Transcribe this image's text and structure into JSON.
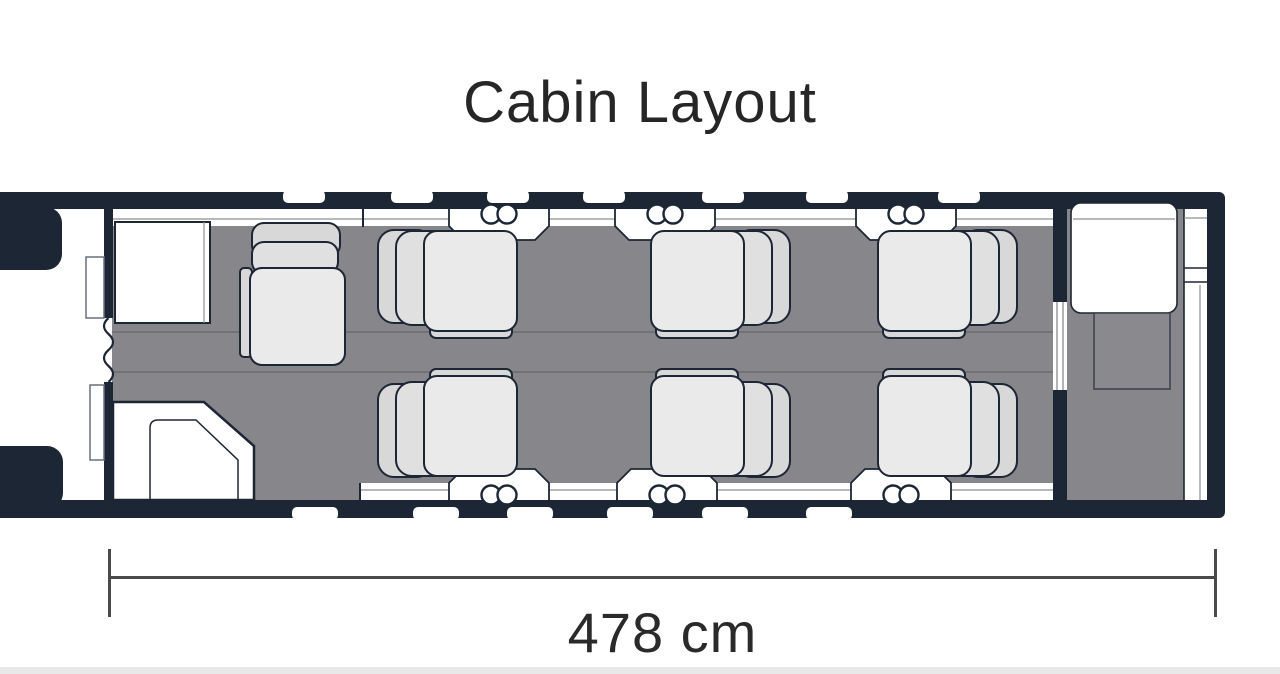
{
  "page": {
    "title": "Cabin Layout"
  },
  "diagram": {
    "dimension": {
      "label": "478 cm"
    },
    "aircraft": {
      "club_seats": 6,
      "side_facing_seats": 1,
      "cockpit_seats": 2,
      "top_windows": 7,
      "bottom_windows": 6,
      "cup_holder_pairs": 6
    }
  },
  "colors": {
    "navy": "#1c2635",
    "floor": "#87868a",
    "seat_light": "#eaeaea",
    "seat_mid": "#e0e0e0",
    "seat_dark": "#d8d8d8",
    "ledge_line": "#8f8f94",
    "dim_line": "#4a4a4a",
    "title_text": "#262626",
    "page_bg": "#ffffff",
    "footer_strip": "#e9e9e9"
  }
}
